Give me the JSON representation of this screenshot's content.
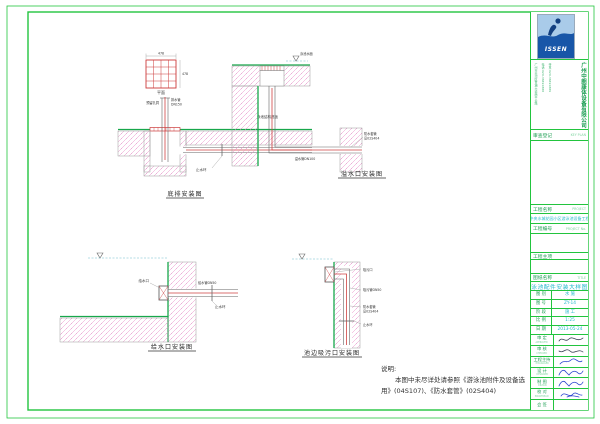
{
  "sheet": {
    "note": {
      "heading": "说明:",
      "line1": "本图中未尽详处请参照《游泳池附件及设备选",
      "line2": "用》(04S107)、《防水套管》(02S404)"
    },
    "drawings": {
      "main_drain": {
        "label": "底排安装图",
        "plan_caption": "平面",
        "dim_top": "478",
        "dim_side": "478",
        "ann_pipe1": "排水管",
        "ann_pipe2": "DN150",
        "ann_reserve": "预留孔洞",
        "ann_floor": "泳池结构底板",
        "ann_waterstop": "止水环"
      },
      "overflow": {
        "label": "溢水口安装图",
        "ann_water": "泳池水面",
        "ann_pipe": "溢水管DN100",
        "ann_sleeve1": "防水套管",
        "ann_sleeve2": "见02S404"
      },
      "inlet": {
        "label": "给水口安装图",
        "ann_nozzle": "给水口",
        "ann_pipe": "给水管DN50",
        "ann_waterstop": "止水环"
      },
      "vacuum": {
        "label": "池边吸污口安装图",
        "ann_fitting": "吸污口",
        "ann_pipe": "吸污管DN50",
        "ann_sleeve1": "防水套管",
        "ann_sleeve2": "见02S404",
        "ann_waterstop": "止水环"
      }
    }
  },
  "title_block": {
    "logo_text": "ISSEN",
    "company": "广州中朗康体设备有限公司",
    "contact_col1": "广州市天河区黄埔大道西平云路",
    "contact_col2": "电话:020-38491888",
    "contact_col3": "传真:020-38491889",
    "review_cn": "审查登记",
    "review_en": "KEY PLAN",
    "project_cn": "工程名称",
    "project_en": "PROJECT",
    "project_name": "中央水城花园小区游泳池设备工程",
    "project_no_cn": "工程编号",
    "project_no_en": "PROJECT No.",
    "subitem_cn": "工程主项",
    "title_cn": "图纸名称",
    "title_en": "TITLE",
    "drawing_title": "泳池配件安装大样图",
    "info_rows": [
      {
        "label": "图 别",
        "value": "水 施"
      },
      {
        "label": "图 号",
        "value": "ZY-14"
      },
      {
        "label": "阶 段",
        "value": "施 工"
      },
      {
        "label": "比 例",
        "value": "1:25"
      },
      {
        "label": "日 期",
        "value": "2013-05-24"
      }
    ],
    "sign_rows": [
      {
        "label": "审 定",
        "en": "APPROVED"
      },
      {
        "label": "审 核",
        "en": "CHECKED"
      },
      {
        "label": "工程主持",
        "en": "P.MANAGER"
      },
      {
        "label": "设 计",
        "en": "DESIGNED"
      },
      {
        "label": "制 图",
        "en": "DRAWN"
      },
      {
        "label": "校 对",
        "en": "PROOFREAD"
      },
      {
        "label": "会 签",
        "en": ""
      }
    ]
  }
}
